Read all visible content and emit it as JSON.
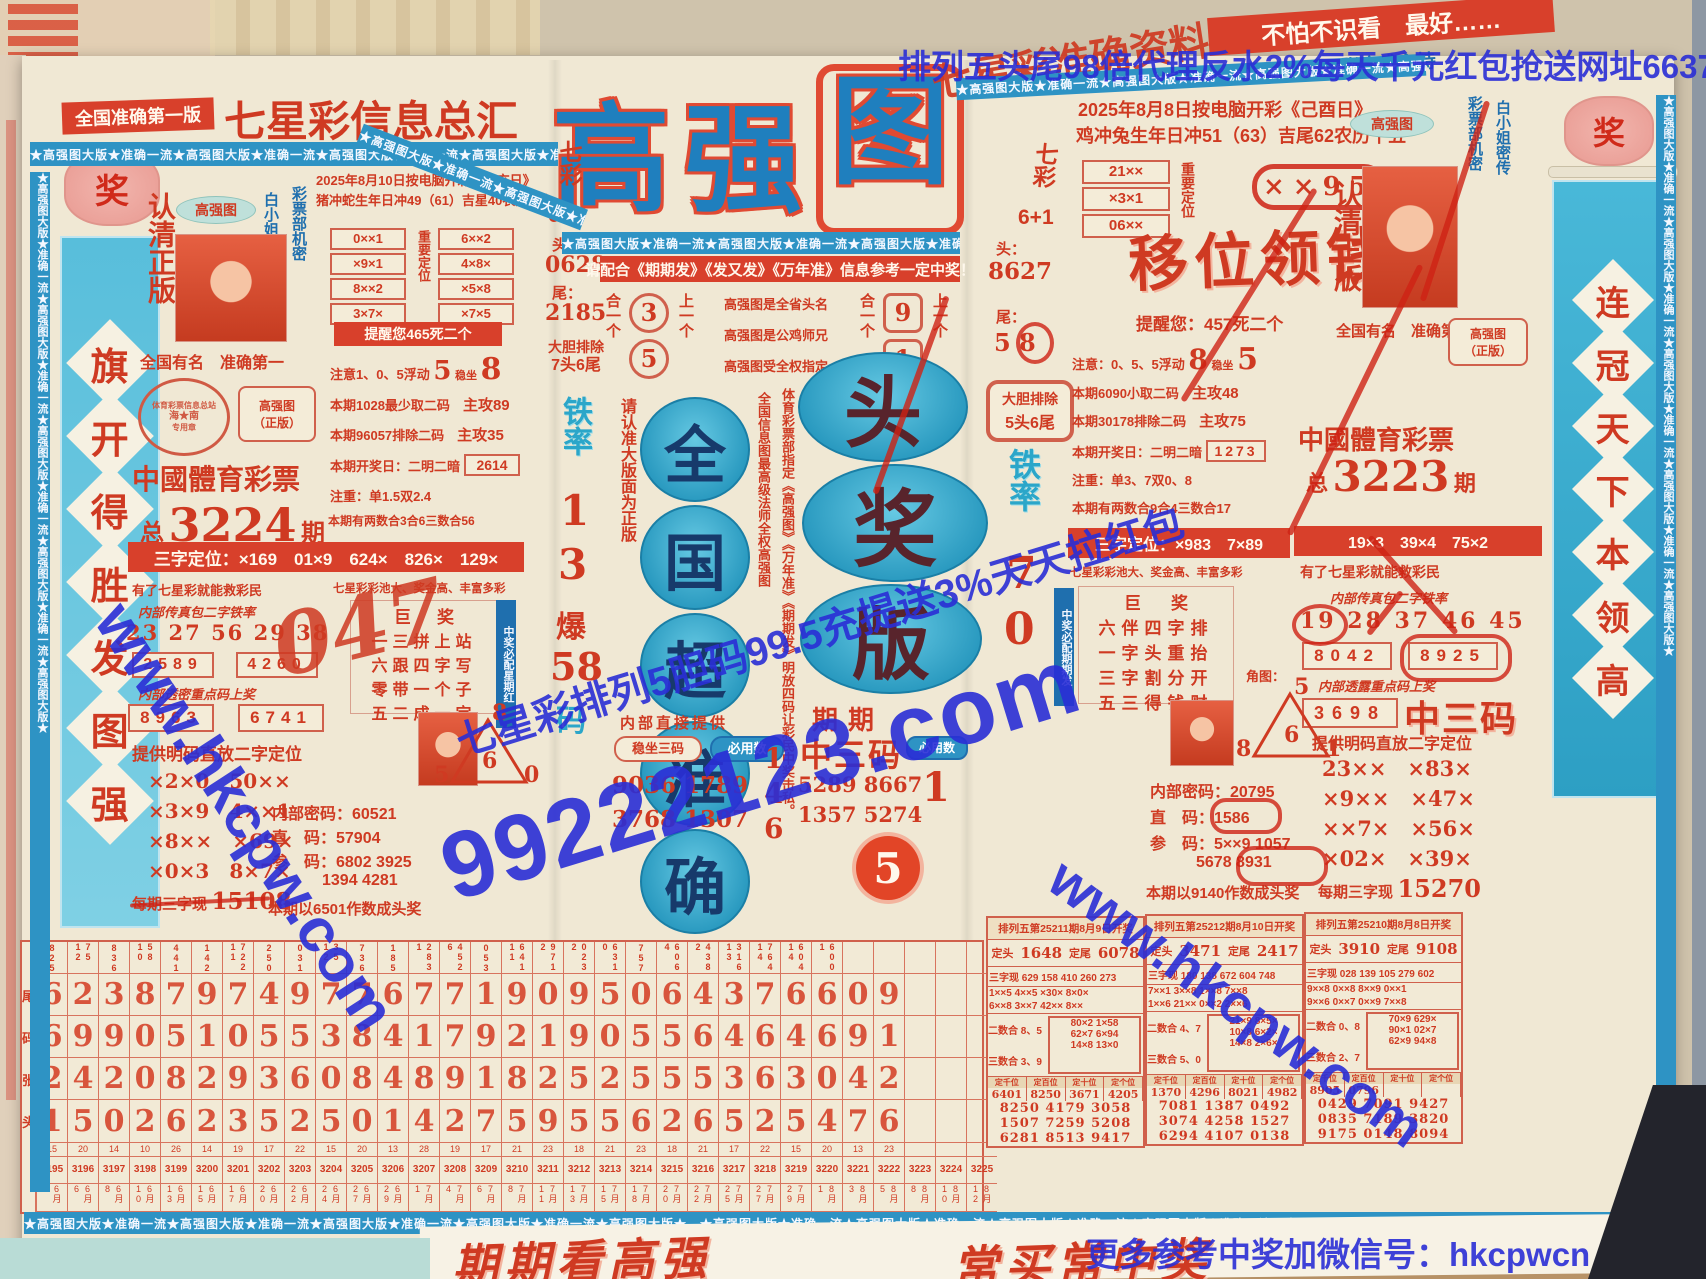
{
  "accent": {
    "red": "#cf3a22",
    "bar_red": "#d8402b",
    "blue": "#1f6fae",
    "teal": "#3ab3d6",
    "wm_blue": "#2a2ed6",
    "title_blue": "#1f7fbe"
  },
  "watermarks": {
    "top": "排列五头尾98倍代理反水2%每天千元红包抢送网址66373.com",
    "site": "www.hkcpw.com",
    "big": "99222123.com",
    "promo": "七星彩排列5胆码99.5充提送3%天天拉红包",
    "wechat": "更多参考中奖加微信号：hkcpwcn"
  },
  "ribbon": "★高强图大版★准确一流★高强图大版★准确一流★高强图大版★准确一流★高强图大版★准确一流★高强图大版★",
  "header": {
    "edition": "全国准确第一版",
    "masthead": "七星彩信息总汇",
    "title": [
      "高",
      "强",
      "图"
    ],
    "rotated": "七星彩准确资料",
    "tr_band": "不怕不识看　最好……",
    "tr_hosts": "白亚香、张广盛主持"
  },
  "left_banner": {
    "lantern": "奖",
    "chars": [
      "旗",
      "开",
      "得",
      "胜",
      "发",
      "图",
      "强"
    ]
  },
  "right_banner": {
    "lantern": "奖",
    "chars": [
      "连",
      "冠",
      "天",
      "下",
      "本",
      "领",
      "高"
    ]
  },
  "left": {
    "date1": "2025年8月10日按电脑开彩《辛亥日》",
    "date2": "猪冲蛇生年日冲49（61）吉星40农历十七",
    "renqing": "认清正版",
    "oval": "高强图",
    "secret1": "彩票部机密",
    "secret2": "白小姐密传",
    "famous": "全国有名　准确第一",
    "stamp1": "体育彩票信息总站",
    "stamp2": "海★南",
    "stamp3": "专用章",
    "box1": "高强图",
    "box2": "（正版）",
    "lottery": "中國體育彩票",
    "period_l": "总",
    "period_n": "3224",
    "period_r": "期",
    "grid_l": [
      "0××1",
      "×9×1",
      "8××2",
      "3×7×"
    ],
    "grid_label": "重要定位",
    "grid_r": [
      "6××2",
      "4×8×",
      "×5×8",
      "×7×5"
    ],
    "remind": "提醒您465死二个",
    "n1a": "注意1、0、5浮动",
    "n1b": "5",
    "n1c": "稳坐",
    "n1d": "8",
    "n2a": "本期1028最少取二码",
    "n2b": "主攻89",
    "n3a": "本期96057排除二码",
    "n3b": "主攻35",
    "n4a": "本期开奖日：二明二暗",
    "n4b": "2614",
    "n5": "注重：单1.5双2.4",
    "n6": "本期有两数合3合6三数合56",
    "sanzi": "三字定位：×169　01×9　624×　826×　129×",
    "slogan1": "有了七星彩就能救彩民",
    "slogan2": "七星彩彩池大、奖金高、丰富多彩",
    "fax": "内部传真包二字铁率",
    "fax_nums": "23 27 56 29 38",
    "fb1": "2589",
    "fb2": "4260",
    "leak": "内部透密重点码上奖",
    "lb1": "8963",
    "lb2": "6741",
    "mingma": "提供明码直放二字定位",
    "pairs": [
      [
        "×2×0",
        "50××"
      ],
      [
        "×3×9",
        "4××1"
      ],
      [
        "×8××",
        "×69×"
      ],
      [
        "×0×3",
        "8×7×"
      ]
    ],
    "per": "每期三字现",
    "per_n": "15108",
    "ju_title": "巨奖",
    "ju_rows": [
      "一三拼上站",
      "六跟四字写",
      "零带一个子",
      "五二成一定"
    ],
    "ju_side": "中奖必配星期红",
    "hand": "047",
    "tri": {
      "t": "8",
      "m": "6",
      "l": "5",
      "r": "0"
    },
    "mima": "内部密码：60521",
    "zhima": "直　码：57904",
    "canma": "参　码：6802 3925",
    "canma2": "1394 4281",
    "final": "本期以6501作数成头奖"
  },
  "center": {
    "qicai": "七彩",
    "six1": "6+1",
    "tou": "头：",
    "tou_n": "0628",
    "wei": "尾：",
    "wei_n": "2185",
    "exclude1": "大胆排除",
    "exclude2": "7头6尾",
    "tie": "铁率",
    "tie1": "1",
    "tie2": "3",
    "bao": "爆",
    "bao_n": "58",
    "bao_m": "码",
    "please": "请配合《期期发》《发又发》《万年准》信息参考一定中奖！",
    "he1l": "合一个",
    "he1n1": "3",
    "he1n2": "5",
    "he1r": "上一个",
    "mid": [
      "高强图是全省头名",
      "高强图是公鸡师兄",
      "高强图受全权指定"
    ],
    "he2l": "合一个",
    "he2n1": "9",
    "he2n2": "1",
    "he2r": "上一个",
    "vleft": "请认准大版面为正版",
    "ovals": [
      "全",
      "国",
      "超",
      "准",
      "确"
    ],
    "vred1": "全国信息图最高级法师全权高强图",
    "vred2": "体育彩票部指定《高强图》《万年准》《期期发》明放四码让彩民中奖击私。",
    "tjb": [
      "头",
      "奖",
      "版"
    ],
    "provide": "内部直接提供",
    "wz1": "稳坐三码",
    "wz2": "必用数",
    "wn1": "9036 1789",
    "wn2": "3768 1307",
    "must": [
      "1",
      "4",
      "6"
    ],
    "qq": "期期",
    "z3": "中三码",
    "qn1": "5289 8667",
    "qn2": "1357 5274",
    "badge": "5",
    "must2": "必用数",
    "must2n": "1"
  },
  "right": {
    "date1": "2025年8月8日按电脑开彩《己酉日》",
    "date2": "鸡冲兔生年日冲51（63）吉尾62农历十五",
    "qicai": "七彩",
    "six1": "6+1",
    "tou": "头：",
    "tou_n": "8627",
    "wei": "尾：",
    "wei_n": "5 8",
    "grid": [
      "21××",
      "×3×1",
      "06××"
    ],
    "grid_label": "重要定位",
    "circ": "××95",
    "yiwei": "移位领钱",
    "remind": "提醒您：457死二个",
    "n1a": "注意：0、5、5浮动",
    "n1b": "8",
    "n1c": "稳坐",
    "n1d": "5",
    "n2a": "本期6090小取二码",
    "n2b": "主攻48",
    "n3a": "本期30178排除二码",
    "n3b": "主攻75",
    "exclude1": "大胆排除",
    "exclude2": "5头6尾",
    "tie": "铁率",
    "tie1": "7",
    "tie2": "0",
    "n4a": "本期开奖日：二明二暗",
    "n4b": "1273",
    "n5": "注重：单3、7双0、8",
    "n6": "本期有两数合9合4三数合17",
    "lottery": "中國體育彩票",
    "period_l": "总",
    "period_n": "3223",
    "period_r": "期",
    "sanzi1": "三字定位：×983　7×89",
    "sanzi2": "19×3　39×4　75×2",
    "slogan1": "七星彩彩池大、奖金高、丰富多彩",
    "slogan2": "有了七星彩就能救彩民",
    "ju_title": "巨奖",
    "ju_rows": [
      "六伴四字排",
      "一字头重抬",
      "三字割分开",
      "五三得钱财"
    ],
    "ju_side": "中奖必配期期发",
    "fax": "内部传真包二字铁率",
    "fax_nums": "19 28 37 46 45",
    "fb1": "8042",
    "fb2": "8925",
    "leak": "内部透露重点码上奖",
    "lb": "3698",
    "z3": "中三码",
    "jiao": "角图：",
    "tri": {
      "t": "5",
      "m": "6",
      "l": "8",
      "r": "1"
    },
    "mima": "内部密码：20795",
    "zhima": "直　码：1586",
    "canma": "参　码：5××9 1057",
    "canma2": "5678 8931",
    "final": "本期以9140作数成头奖",
    "mingma": "提供明码直放二字定位",
    "pairs": [
      [
        "23××",
        "×83×"
      ],
      [
        "×9××",
        "×47×"
      ],
      [
        "××7×",
        "×56×"
      ],
      [
        "×02×",
        "×39×"
      ]
    ],
    "per": "每期三字现",
    "per_n": "15270",
    "renqing": "认清正版",
    "famous": "全国有名　准确第一",
    "oval": "高强图",
    "secret1": "彩票部机密",
    "secret2": "白小姐密传",
    "box1": "高强图",
    "box2": "（正版）"
  },
  "history": {
    "row_labels": [
      "尾",
      "码",
      "张",
      "头"
    ],
    "columns": [
      {
        "top": "825",
        "d1": "6",
        "d2": "6",
        "d3": "2",
        "d4": "1",
        "n": "15",
        "p": "3195",
        "date": "6月3"
      },
      {
        "top": "75 12",
        "d1": "2",
        "d2": "9",
        "d3": "4",
        "d4": "5",
        "n": "20",
        "p": "3196",
        "date": "6月6"
      },
      {
        "top": "836",
        "d1": "3",
        "d2": "9",
        "d3": "2",
        "d4": "0",
        "n": "14",
        "p": "3197",
        "date": "6月8"
      },
      {
        "top": "58 10",
        "d1": "8",
        "d2": "0",
        "d3": "0",
        "d4": "2",
        "n": "10",
        "p": "3198",
        "date": "6月10"
      },
      {
        "top": "441",
        "d1": "7",
        "d2": "5",
        "d3": "8",
        "d4": "6",
        "n": "26",
        "p": "3199",
        "date": "6月13"
      },
      {
        "top": "142",
        "d1": "9",
        "d2": "1",
        "d3": "2",
        "d4": "2",
        "n": "14",
        "p": "3200",
        "date": "6月15"
      },
      {
        "top": "722 11",
        "d1": "7",
        "d2": "0",
        "d3": "9",
        "d4": "3",
        "n": "19",
        "p": "3201",
        "date": "6月17"
      },
      {
        "top": "250",
        "d1": "4",
        "d2": "5",
        "d3": "3",
        "d4": "5",
        "n": "17",
        "p": "3202",
        "date": "6月20"
      },
      {
        "top": "031",
        "d1": "9",
        "d2": "5",
        "d3": "6",
        "d4": "2",
        "n": "22",
        "p": "3203",
        "date": "6月22"
      },
      {
        "top": "35 12",
        "d1": "7",
        "d2": "3",
        "d3": "0",
        "d4": "5",
        "n": "15",
        "p": "3204",
        "date": "6月24"
      },
      {
        "top": "736",
        "d1": "7",
        "d2": "8",
        "d3": "8",
        "d4": "0",
        "n": "20",
        "p": "3205",
        "date": "6月27"
      },
      {
        "top": "185",
        "d1": "6",
        "d2": "4",
        "d3": "4",
        "d4": "1",
        "n": "13",
        "p": "3206",
        "date": "6月29"
      },
      {
        "top": "283 1",
        "d1": "7",
        "d2": "1",
        "d3": "8",
        "d4": "4",
        "n": "28",
        "p": "3207",
        "date": "7月1"
      },
      {
        "top": "452 6",
        "d1": "7",
        "d2": "7",
        "d3": "9",
        "d4": "2",
        "n": "19",
        "p": "3208",
        "date": "7月4"
      },
      {
        "top": "053",
        "d1": "1",
        "d2": "9",
        "d3": "1",
        "d4": "7",
        "n": "17",
        "p": "3209",
        "date": "7月6"
      },
      {
        "top": "641 11",
        "d1": "9",
        "d2": "2",
        "d3": "8",
        "d4": "5",
        "n": "21",
        "p": "3210",
        "date": "7月8"
      },
      {
        "top": "971 2",
        "d1": "0",
        "d2": "1",
        "d3": "2",
        "d4": "9",
        "n": "23",
        "p": "3211",
        "date": "7月11"
      },
      {
        "top": "023 2",
        "d1": "9",
        "d2": "9",
        "d3": "5",
        "d4": "5",
        "n": "18",
        "p": "3212",
        "date": "7月13"
      },
      {
        "top": "631 0",
        "d1": "5",
        "d2": "0",
        "d3": "2",
        "d4": "5",
        "n": "21",
        "p": "3213",
        "date": "7月15"
      },
      {
        "top": "757",
        "d1": "0",
        "d2": "5",
        "d3": "5",
        "d4": "6",
        "n": "23",
        "p": "3214",
        "date": "7月18"
      },
      {
        "top": "606 4",
        "d1": "6",
        "d2": "5",
        "d3": "5",
        "d4": "2",
        "n": "18",
        "p": "3215",
        "date": "7月20"
      },
      {
        "top": "438 2",
        "d1": "4",
        "d2": "6",
        "d3": "5",
        "d4": "6",
        "n": "21",
        "p": "3216",
        "date": "7月22"
      },
      {
        "top": "316 13",
        "d1": "3",
        "d2": "4",
        "d3": "3",
        "d4": "5",
        "n": "17",
        "p": "3217",
        "date": "7月25"
      },
      {
        "top": "764 14",
        "d1": "7",
        "d2": "6",
        "d3": "6",
        "d4": "2",
        "n": "22",
        "p": "3218",
        "date": "7月27"
      },
      {
        "top": "604 14",
        "d1": "6",
        "d2": "4",
        "d3": "3",
        "d4": "5",
        "n": "15",
        "p": "3219",
        "date": "7月29"
      },
      {
        "top": "600 1",
        "d1": "6",
        "d2": "6",
        "d3": "0",
        "d4": "4",
        "n": "20",
        "p": "3220",
        "date": "8月1"
      },
      {
        "top": "",
        "d1": "0",
        "d2": "9",
        "d3": "4",
        "d4": "7",
        "n": "13",
        "p": "3221",
        "date": "8月3"
      },
      {
        "top": "",
        "d1": "9",
        "d2": "1",
        "d3": "2",
        "d4": "6",
        "n": "23",
        "p": "3222",
        "date": "8月5"
      },
      {
        "top": "",
        "d1": "",
        "d2": "",
        "d3": "",
        "d4": "",
        "n": "",
        "p": "3223",
        "date": "8月8"
      },
      {
        "top": "",
        "d1": "",
        "d2": "",
        "d3": "",
        "d4": "",
        "n": "",
        "p": "3224",
        "date": "8月10"
      },
      {
        "top": "",
        "d1": "",
        "d2": "",
        "d3": "",
        "d4": "",
        "n": "",
        "p": "3225",
        "date": "8月12"
      }
    ]
  },
  "p5": [
    {
      "title": "排列五第25211期8月9日开奖",
      "head_l": "定头",
      "head_v": "1648",
      "tail_l": "定尾",
      "tail_v": "6078",
      "sanzi": "三字现 629 158 410 260 273",
      "pat1": "1××5 4××5 ×30× 8×0×",
      "pat2": "6××8 3××7 42×× 8××",
      "he2": "二数合 8、5",
      "he3": "三数合 3、9",
      "box": [
        "80×2 1×58",
        "62×7 6×94",
        "14×8 13×0"
      ],
      "dw": [
        {
          "l": "定千位",
          "v": "6401"
        },
        {
          "l": "定百位",
          "v": "8250"
        },
        {
          "l": "定十位",
          "v": "3671"
        },
        {
          "l": "定个位",
          "v": "4205"
        }
      ],
      "rows": [
        "8250 4179 3058",
        "1507 7259 5208",
        "6281 8513 9417"
      ]
    },
    {
      "title": "排列五第25212期8月10日开奖",
      "head_l": "定头",
      "head_v": "3471",
      "tail_l": "定尾",
      "tail_v": "2417",
      "sanzi": "三字现 180 138 672 604 748",
      "pat1": "7××1 3××8 1××8 7××8",
      "pat2": "1××6 21×× 0××2 2××6",
      "he2": "二数合 4、7",
      "he3": "三数合 5、0",
      "box": [
        "21×9 8×5×",
        "10×8 6×2×",
        "14×8 2×6×"
      ],
      "dw": [
        {
          "l": "定千位",
          "v": "1370"
        },
        {
          "l": "定百位",
          "v": "4296"
        },
        {
          "l": "定十位",
          "v": "8021"
        },
        {
          "l": "定个位",
          "v": "4982"
        }
      ],
      "rows": [
        "7081 1387 0492",
        "3074 4258 1527",
        "6294 4107 0138"
      ]
    },
    {
      "title": "排列五第25210期8月8日开奖",
      "head_l": "定头",
      "head_v": "3910",
      "tail_l": "定尾",
      "tail_v": "9108",
      "sanzi": "三字现 028 139 105 279 602",
      "pat1": "9××8 0××8 8××9 0××1",
      "pat2": "9××6 0××7 0××9 7××8",
      "he2": "二数合 0、8",
      "he3": "三数合 2、7",
      "box": [
        "70×9 629×",
        "90×1 02×7",
        "62×9 94×8"
      ],
      "dw": [
        {
          "l": "定千位",
          "v": "8905"
        },
        {
          "l": "定百位",
          "v": "0796"
        },
        {
          "l": "定十位",
          "v": ""
        },
        {
          "l": "定个位",
          "v": ""
        }
      ],
      "rows": [
        "0429 7091 9427",
        "0835 7189 3820",
        "9175 0148 8094"
      ]
    }
  ],
  "footer": {
    "s1": "期期看高强",
    "s2": "常买常中奖"
  }
}
